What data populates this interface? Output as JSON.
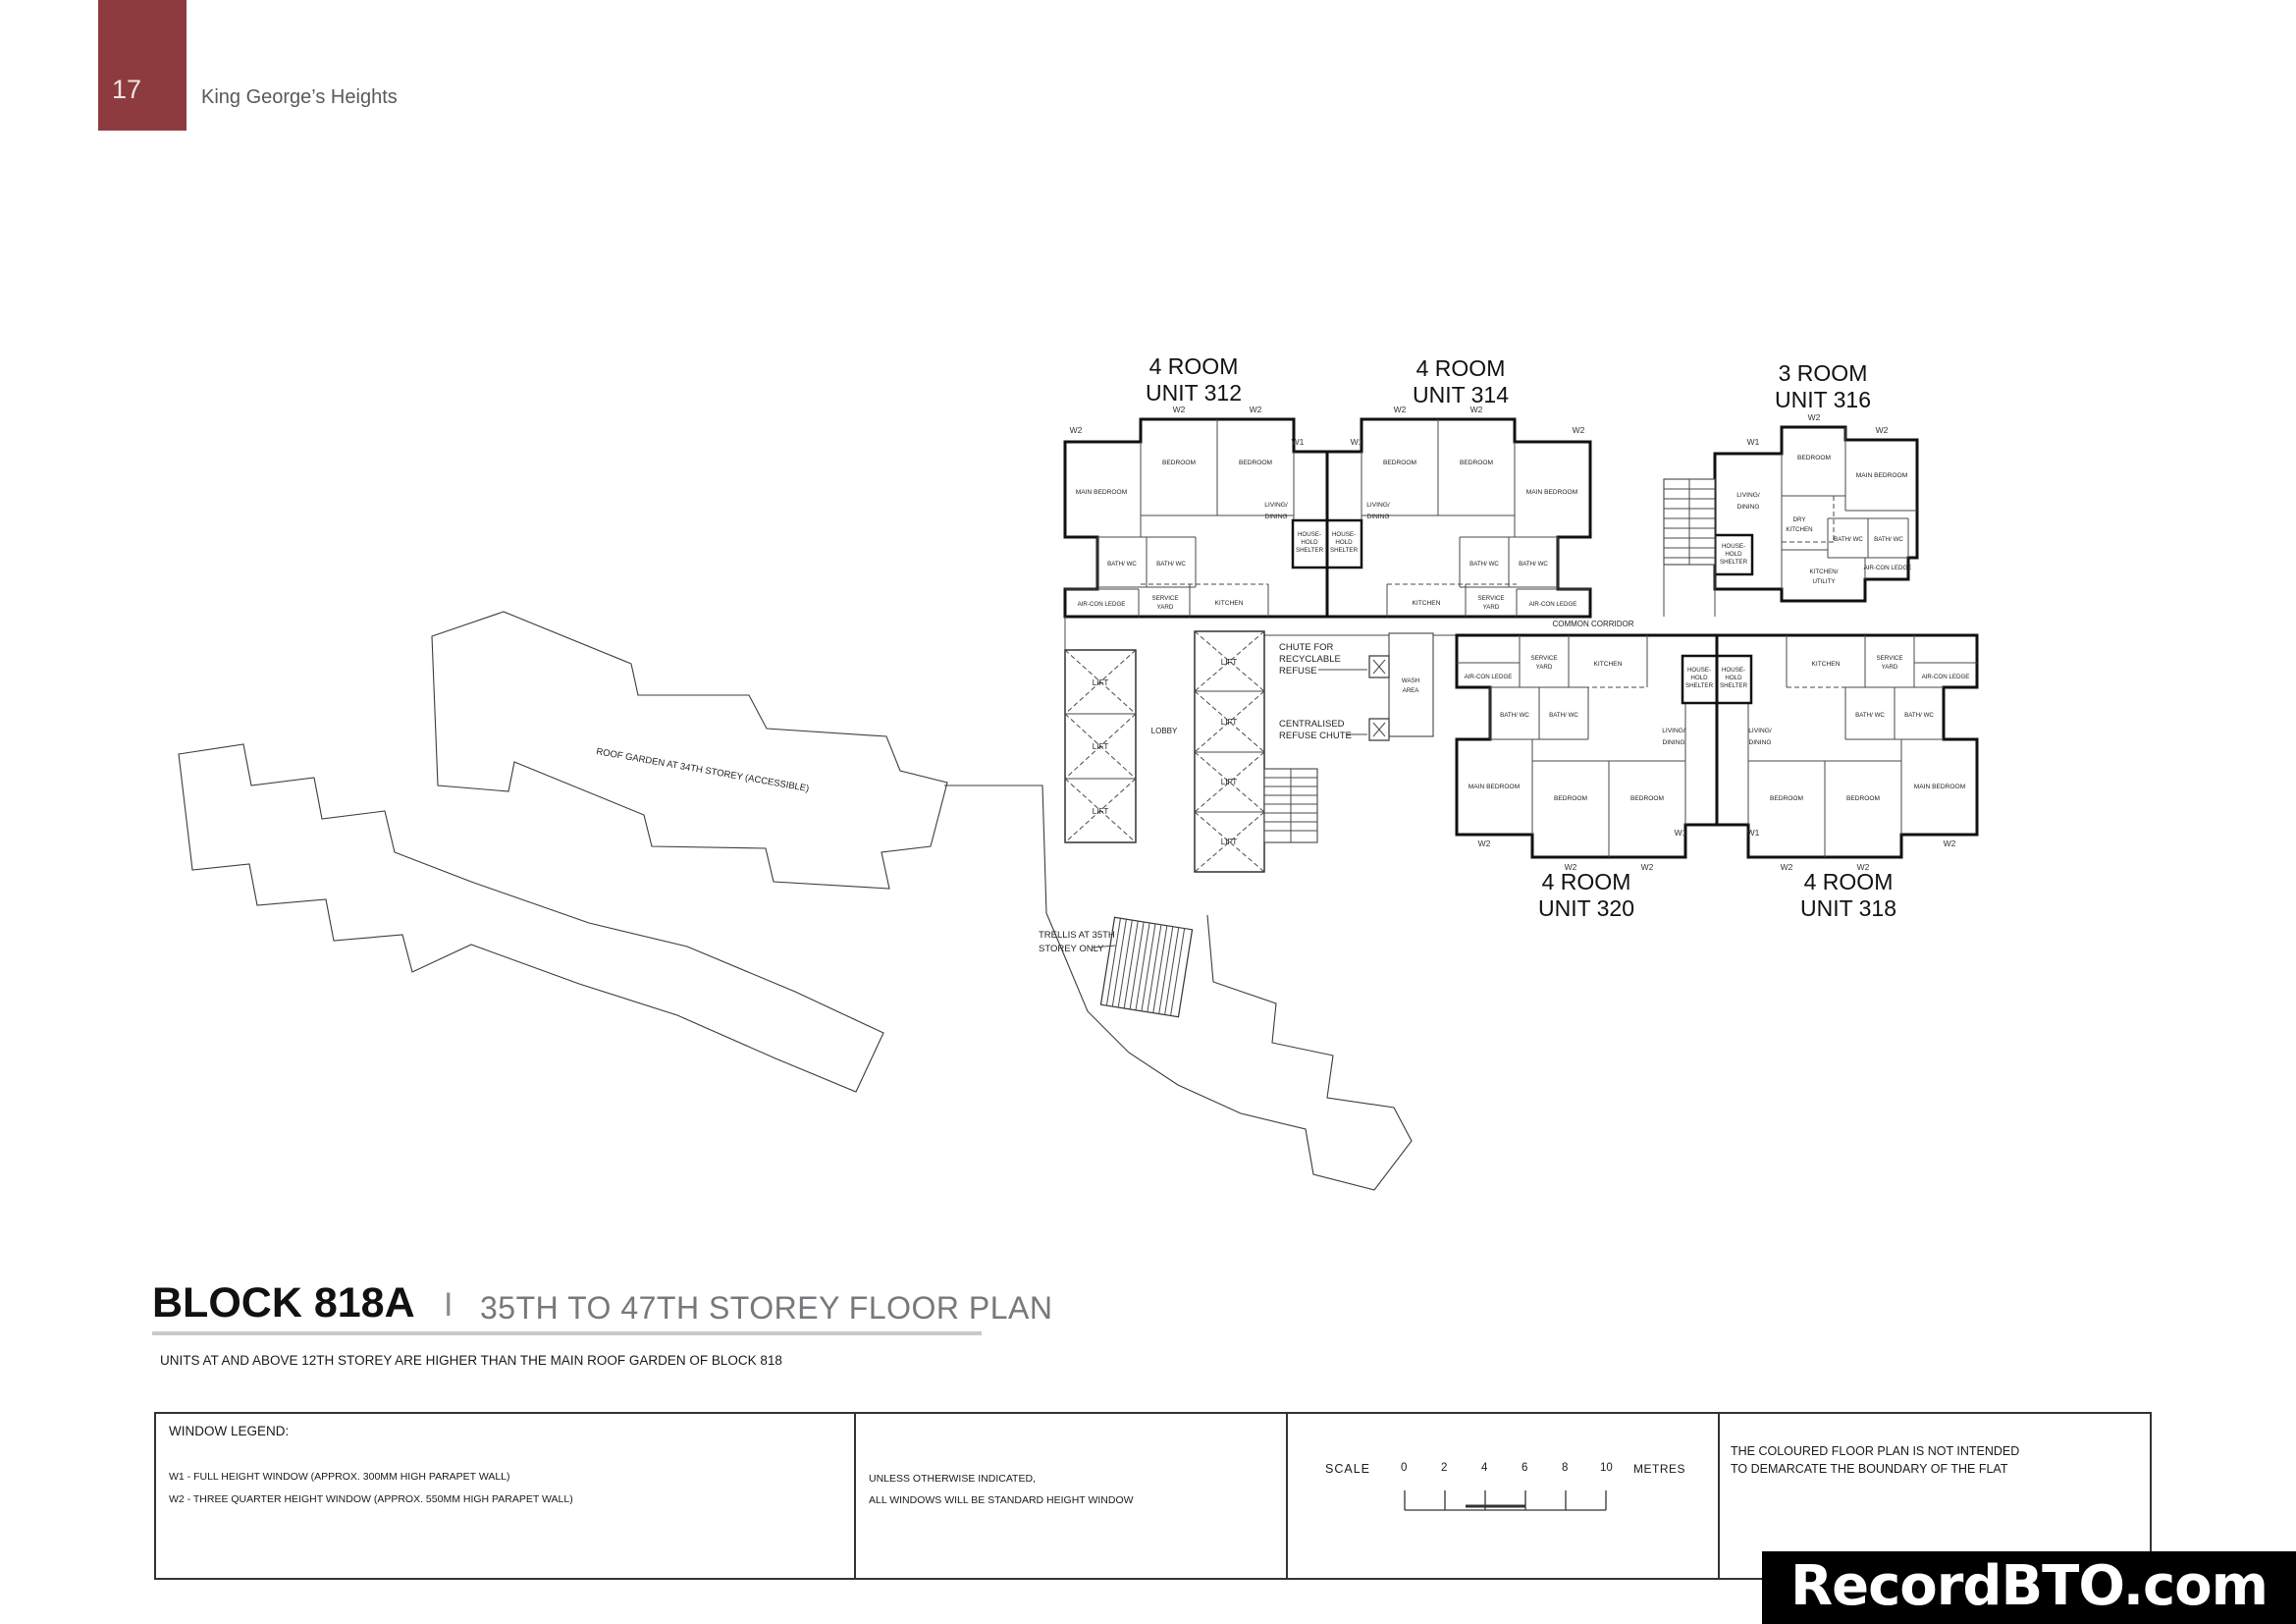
{
  "header": {
    "page_number": "17",
    "project_name": "King George’s Heights"
  },
  "plan": {
    "unit_titles": {
      "u312_1": "4 ROOM",
      "u312_2": "UNIT 312",
      "u314_1": "4 ROOM",
      "u314_2": "UNIT 314",
      "u316_1": "3 ROOM",
      "u316_2": "UNIT 316",
      "u318_1": "4 ROOM",
      "u318_2": "UNIT 318",
      "u320_1": "4 ROOM",
      "u320_2": "UNIT 320"
    },
    "rooms": {
      "main_bedroom": "MAIN BEDROOM",
      "bedroom": "BEDROOM",
      "living_1": "LIVING/",
      "living_2": "DINING",
      "bath_wc": "BATH/ WC",
      "kitchen": "KITCHEN",
      "service_1": "SERVICE",
      "service_2": "YARD",
      "aircon_ledge": "AIR-CON LEDGE",
      "house_1": "HOUSE-",
      "house_2": "HOLD",
      "house_3": "SHELTER",
      "dry_1": "DRY",
      "dry_2": "KITCHEN",
      "kitchen_utility_1": "KITCHEN/",
      "kitchen_utility_2": "UTILITY"
    },
    "window_labels": {
      "w1": "W1",
      "w2": "W2"
    },
    "core": {
      "lift": "LIFT",
      "lobby": "LOBBY",
      "wash_1": "WASH",
      "wash_2": "AREA",
      "chute_1": "CHUTE FOR",
      "chute_2": "RECYCLABLE",
      "chute_3": "REFUSE",
      "central_1": "CENTRALISED",
      "central_2": "REFUSE CHUTE",
      "corridor": "COMMON CORRIDOR"
    },
    "annotations": {
      "roof_garden": "ROOF GARDEN AT 34TH STOREY (ACCESSIBLE)",
      "trellis_1": "TRELLIS AT 35TH",
      "trellis_2": "STOREY ONLY"
    }
  },
  "title_block": {
    "block": "BLOCK 818A",
    "separator": "I",
    "subtitle": "35TH TO 47TH STOREY FLOOR PLAN",
    "note": "UNITS AT AND ABOVE 12TH STOREY ARE HIGHER THAN THE MAIN ROOF GARDEN OF BLOCK 818"
  },
  "legend": {
    "window_legend_title": "WINDOW LEGEND:",
    "w1_line": "W1 - FULL HEIGHT WINDOW (APPROX. 300MM HIGH PARAPET WALL)",
    "w2_line": "W2 - THREE QUARTER HEIGHT WINDOW (APPROX. 550MM HIGH PARAPET WALL)",
    "windows_note_1": "UNLESS OTHERWISE INDICATED,",
    "windows_note_2": "ALL WINDOWS WILL BE STANDARD HEIGHT WINDOW",
    "scale_label": "SCALE",
    "scale_ticks": [
      "0",
      "2",
      "4",
      "6",
      "8",
      "10"
    ],
    "scale_unit": "METRES",
    "boundary_note_1": "THE COLOURED FLOOR PLAN IS NOT INTENDED",
    "boundary_note_2": "TO DEMARCATE THE BOUNDARY OF THE FLAT"
  },
  "watermark": "RecordBTO.com",
  "colors": {
    "four_room": "#F3EA7B",
    "three_room": "#A9CE97",
    "header_block": "#8E3B40"
  }
}
